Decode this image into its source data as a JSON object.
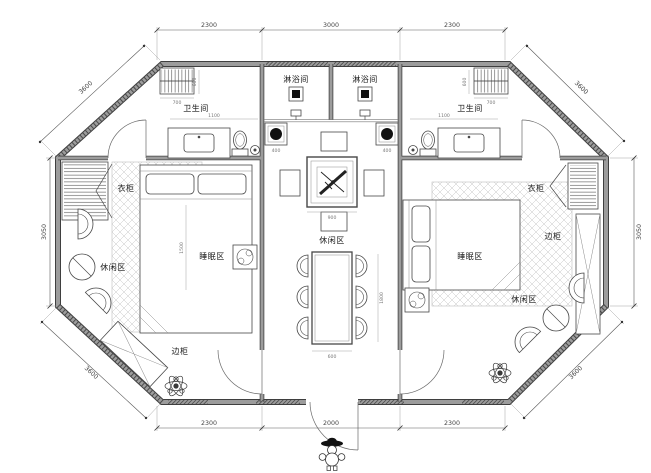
{
  "rooms": {
    "shower_left": "淋浴间",
    "shower_right": "淋浴间",
    "bath_left": "卫生间",
    "bath_right": "卫生间",
    "wardrobe_left": "衣柜",
    "wardrobe_right": "衣柜",
    "side_cabinet_left": "边柜",
    "side_cabinet_right": "边柜",
    "leisure_left": "休闲区",
    "leisure_center": "休闲区",
    "leisure_right": "休闲区",
    "sleep_left": "睡眠区",
    "sleep_right": "睡眠区"
  },
  "dimensions": {
    "top": [
      "2300",
      "3000",
      "2300"
    ],
    "bottom": [
      "2300",
      "2000",
      "2300"
    ],
    "left": "3050",
    "right": "3050",
    "diag_tl": "3600",
    "diag_tr": "3600",
    "diag_bl": "3600",
    "diag_br": "3600",
    "small": {
      "rack_w": "700",
      "rack_h": "600",
      "bath_w": "1100",
      "basin": "400",
      "tea_table": "900",
      "dining_w": "600",
      "dining_l": "1800",
      "bed_l": "1500"
    }
  },
  "colors": {
    "paper": "#ffffff",
    "wall_edge": "#3f3f3f",
    "wall_core": "#9c9c9c",
    "line": "#474747",
    "dim": "#555555"
  }
}
